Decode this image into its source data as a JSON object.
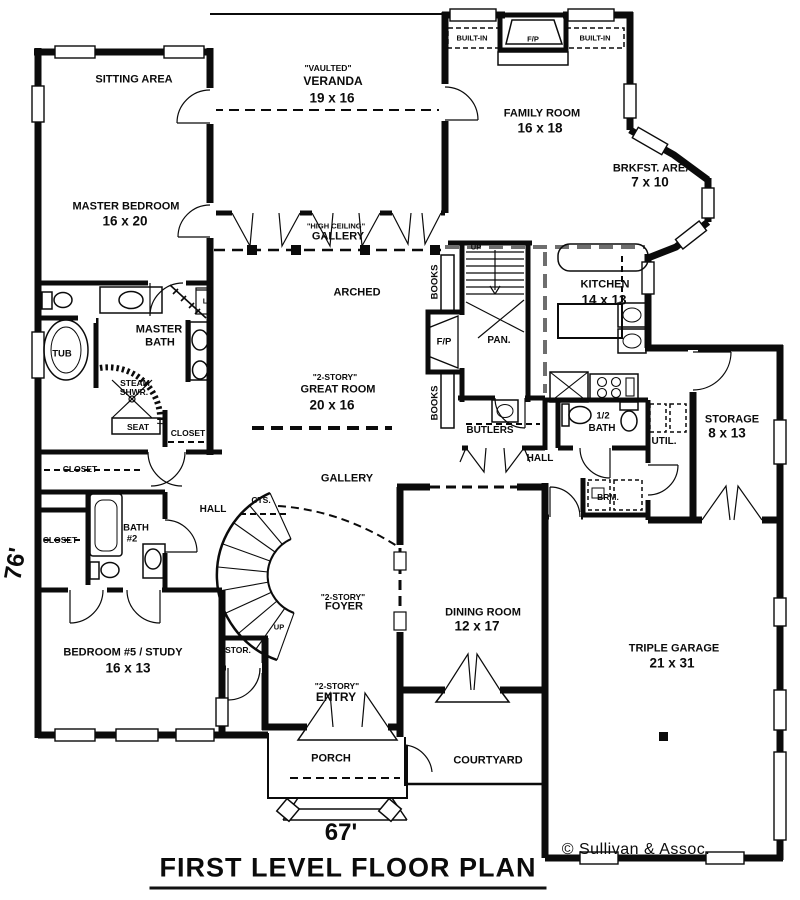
{
  "title": "FIRST LEVEL FLOOR PLAN",
  "copyright": "© Sullivan & Assoc.",
  "width_dim": "67'",
  "depth_dim": "76'",
  "labels": {
    "sitting_area": "SITTING AREA",
    "vaulted": "\"VAULTED\"",
    "veranda": "VERANDA",
    "veranda_dim": "19 x 16",
    "built_in_left": "BUILT-IN",
    "fp_top": "F/P",
    "built_in_right": "BUILT-IN",
    "family_room": "FAMILY ROOM",
    "family_room_dim": "16 x 18",
    "brkfst_area": "BRKFST. AREA",
    "brkfst_dim": "7 x 10",
    "master_bedroom": "MASTER BEDROOM",
    "master_bedroom_dim": "16 x 20",
    "high_ceiling": "\"HIGH CEILING\"",
    "gallery_upper": "GALLERY",
    "arched": "ARCHED",
    "kitchen": "KITCHEN",
    "kitchen_dim": "14 x 13",
    "books_upper": "BOOKS",
    "books_lower": "BOOKS",
    "fp_great": "F/P",
    "pan": "PAN.",
    "up_back_stair": "UP",
    "master_line1": "MASTER",
    "master_line2": "BATH",
    "tub": "TUB",
    "steam_line1": "STEAM",
    "steam_line2": "SHWR.",
    "seat": "SEAT",
    "closet_master": "CLOSET",
    "linen": "L",
    "story2_great": "\"2-STORY\"",
    "great_room": "GREAT ROOM",
    "great_room_dim": "20 x 16",
    "butlers": "BUTLERS",
    "half_bath_line1": "1/2",
    "half_bath_line2": "BATH",
    "util": "UTIL.",
    "storage": "STORAGE",
    "storage_dim": "8 x 13",
    "hall_right": "HALL",
    "brm": "BRM.",
    "closet_hall_upper": "CLOSET",
    "closet_hall_lower": "CLOSET",
    "bath2_line1": "BATH",
    "bath2_line2": "#2",
    "hall_left": "HALL",
    "cts": "CTS.",
    "up_main_stair": "UP",
    "stor": "STOR.",
    "gallery_lower": "GALLERY",
    "story2_foyer": "\"2-STORY\"",
    "foyer": "FOYER",
    "dining_room": "DINING ROOM",
    "dining_dim": "12 x 17",
    "bedroom5": "BEDROOM #5 / STUDY",
    "bedroom5_dim": "16 x 13",
    "story2_entry": "\"2-STORY\"",
    "entry": "ENTRY",
    "porch": "PORCH",
    "courtyard": "COURTYARD",
    "garage": "TRIPLE GARAGE",
    "garage_dim": "21 x 31"
  }
}
